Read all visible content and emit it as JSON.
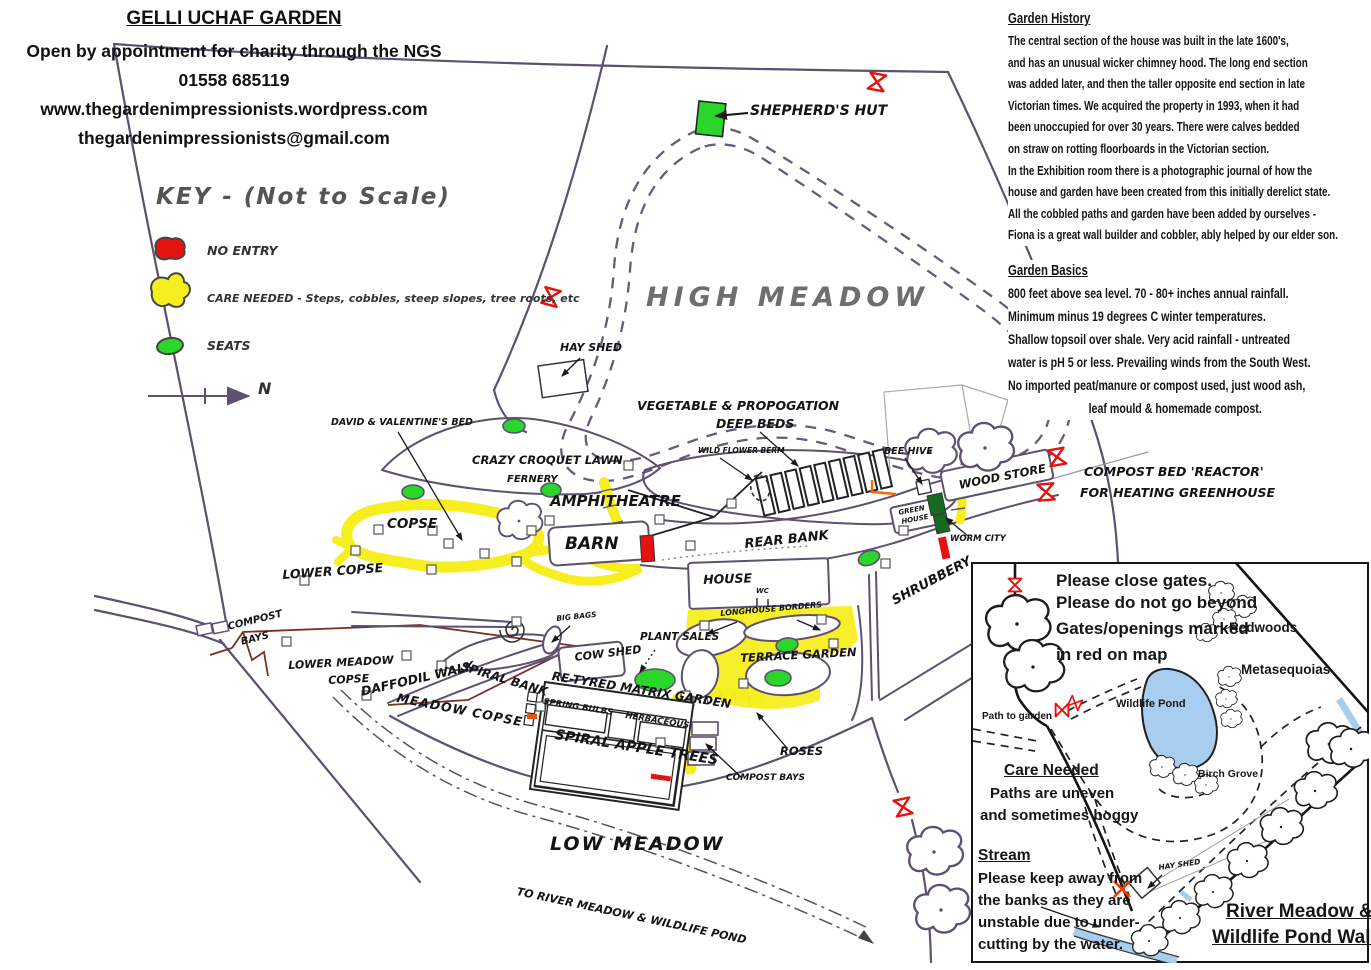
{
  "header": {
    "title": "GELLI UCHAF GARDEN",
    "line1": "Open by appointment for charity through the NGS",
    "phone": "01558 685119",
    "website": "www.thegardenimpressionists.wordpress.com",
    "email": "thegardenimpressionists@gmail.com"
  },
  "key": {
    "title": "KEY  -  (Not to Scale)",
    "no_entry": "NO ENTRY",
    "care_needed": "CARE NEEDED - Steps, cobbles, steep slopes, tree roots, etc",
    "seats": "SEATS",
    "north": "N"
  },
  "history": {
    "title": "Garden History",
    "lines": [
      "The central section of the house was built in the late 1600's,",
      "and has an unusual wicker chimney hood. The long end section",
      "was added later, and then the taller opposite end section in late",
      "Victorian times. We acquired the property in 1993, when it had",
      "been unoccupied for over 30 years. There were calves bedded",
      "on straw on rotting floorboards in the Victorian section.",
      "In the Exhibition room there is a photographic journal of how the",
      "house and garden have been created from this initially derelict state.",
      "All the cobbled paths and garden have been added by ourselves -",
      "Fiona is a great wall builder and cobbler, ably helped by our elder son."
    ]
  },
  "basics": {
    "title": "Garden Basics",
    "lines": [
      "800 feet above sea level. 70 - 80+ inches annual rainfall.",
      "Minimum minus 19 degrees C winter temperatures.",
      "Shallow topsoil over shale. Very acid rainfall - untreated",
      "water is pH 5 or less. Prevailing winds from the South West.",
      "No imported peat/manure or compost used, just wood ash,",
      "leaf mould & homemade compost."
    ]
  },
  "map": {
    "shepherds_hut": "SHEPHERD'S HUT",
    "high_meadow": "HIGH MEADOW",
    "hay_shed": "HAY SHED",
    "veg_beds_1": "VEGETABLE & PROPOGATION",
    "veg_beds_2": "DEEP BEDS",
    "wild_flower_berm": "WILD FLOWER BERM",
    "bee_hive": "BEE HIVE",
    "wood_store": "WOOD STORE",
    "green_house_1": "GREEN",
    "green_house_2": "HOUSE",
    "worm_city": "WORM CITY",
    "reactor_1": "COMPOST BED 'REACTOR'",
    "reactor_2": "FOR HEATING GREENHOUSE",
    "david_valentines_bed": "DAVID & VALENTINE'S BED",
    "crazy_croquet_lawn": "CRAZY CROQUET LAWN",
    "fernery": "FERNERY",
    "amphitheatre": "AMPHITHEATRE",
    "copse": "COPSE",
    "barn": "BARN",
    "lower_copse": "LOWER COPSE",
    "rear_bank": "REAR BANK",
    "shrubbery": "SHRUBBERY",
    "house": "HOUSE",
    "wc": "WC",
    "longhouse_borders": "LONGHOUSE BORDERS",
    "compost_bays_1": "COMPOST",
    "compost_bays_2": "BAYS",
    "lower_meadow_copse_1": "LOWER MEADOW",
    "lower_meadow_copse_2": "COPSE",
    "daffodil_walk": "DAFFODIL  WALK",
    "spiral_bank": "SPIRAL BANK",
    "meadow_copse": "MEADOW COPSE",
    "big_bags": "BIG BAGS",
    "cow_shed": "COW SHED",
    "plant_sales": "PLANT SALES",
    "matrix_garden": "RE-TYRED MATRIX GARDEN",
    "spring_bulbs": "SPRING BULBS",
    "herbaceous": "HERBACEOUS",
    "spiral_apple_trees": "SPIRAL APPLE TREES",
    "terrace_garden": "TERRACE GARDEN",
    "roses": "ROSES",
    "compost_bays_lower": "COMPOST BAYS",
    "low_meadow": "LOW MEADOW",
    "to_river_meadow": "TO RIVER MEADOW & WILDLIFE POND"
  },
  "inset": {
    "notice_1": "Please close gates.",
    "notice_2": "Please do not go beyond",
    "notice_3": "Gates/openings marked",
    "notice_4": "in red on map",
    "redwoods": "Redwoods",
    "metasequoias": "Metasequoias",
    "wildlife_pond": "Wildlife Pond",
    "path_to_garden": "Path to garden",
    "birch_grove": "Birch Grove",
    "hay_shed": "HAY SHED",
    "care_title": "Care Needed",
    "care_1": "Paths are uneven",
    "care_2": "and sometimes boggy",
    "stream_title": "Stream",
    "stream_1": "Please keep away from",
    "stream_2": "the banks as they are",
    "stream_3": "unstable due to under-",
    "stream_4": "cutting by the water.",
    "title_1": "River Meadow &",
    "title_2": "Wildlife Pond Walk"
  },
  "colors": {
    "no_entry": "#e51310",
    "care_needed": "#f6ee1f",
    "seats": "#2bd62b",
    "map_line": "#5e5070",
    "dark_green": "#166b1e",
    "pond": "#a9cdee"
  }
}
